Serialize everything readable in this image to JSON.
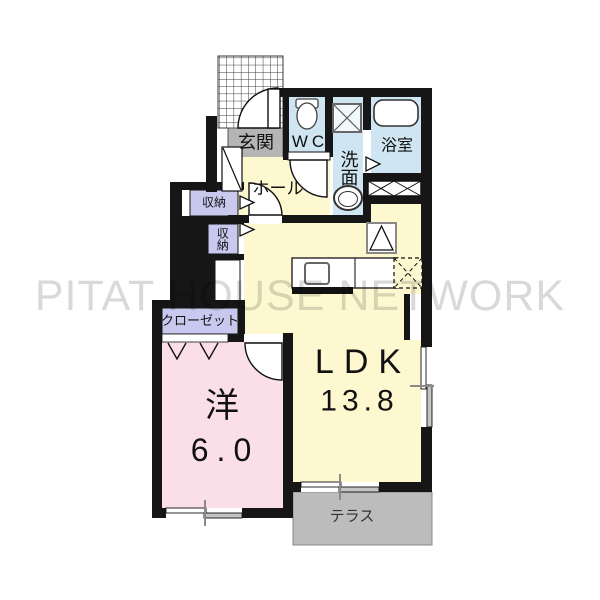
{
  "watermark": "PITAT HOUSE NETWORK",
  "rooms": {
    "entrance": {
      "label": "玄関"
    },
    "toilet": {
      "label": "WC"
    },
    "washroom": {
      "label": "洗面"
    },
    "bathroom": {
      "label": "浴室"
    },
    "hall": {
      "label": "ホール"
    },
    "storage_upper": {
      "label": "収納"
    },
    "storage_lower": {
      "label": "収納"
    },
    "closet": {
      "label": "クローゼット"
    },
    "western_room": {
      "label": "洋",
      "size": "6.0"
    },
    "ldk": {
      "label": "LDK",
      "size": "13.8"
    },
    "terrace": {
      "label": "テラス"
    }
  },
  "fixtures": [
    "entry-porch-grid",
    "door-swing",
    "toilet",
    "washing-machine-pan",
    "wash-basin",
    "bathtub",
    "kitchen-counter",
    "kitchen-sink",
    "water-heater-triangle",
    "refrigerator-space-dashed",
    "storage-door-arrow",
    "folding-closet-door",
    "sliding-window",
    "terrace"
  ],
  "colors": {
    "wall": "#161616",
    "water_area_fill": "#cfe6f2",
    "living_fill": "#fdf8d0",
    "bedroom_fill": "#fbdfe8",
    "storage_fill": "#c9c9ef",
    "entrance_step_fill": "#b5b5b5",
    "terrace_fill": "#bcbcbc",
    "watermark_color": "#d7d7d7"
  }
}
